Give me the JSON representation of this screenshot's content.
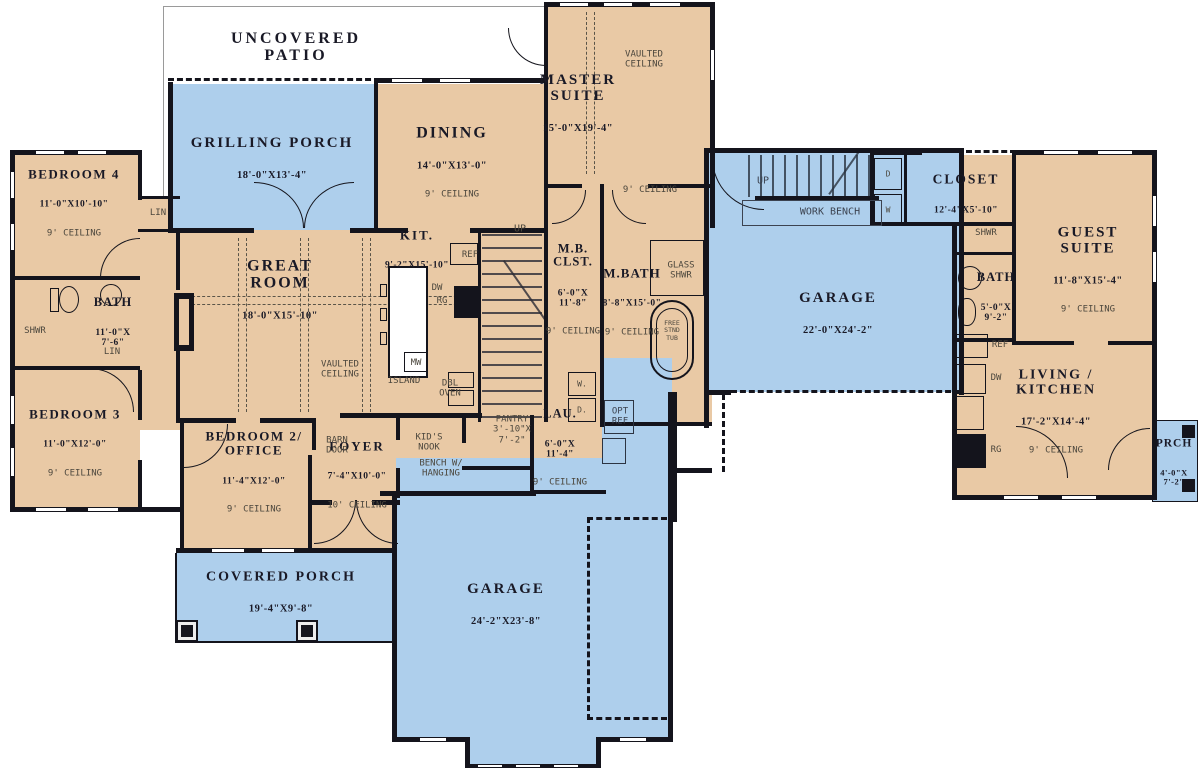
{
  "plan_title": "First floor plan",
  "colors": {
    "room_fill_tan": "#e9c9a5",
    "porch_garage_blue": "#aecfec",
    "wall": "#14141c",
    "room_label": "#191926",
    "annotation": "#4c473d",
    "background": "#ffffff"
  },
  "rooms": {
    "patio": {
      "name": "UNCOVERED\nPATIO"
    },
    "grilling": {
      "name": "GRILLING PORCH",
      "dims": "18'-0\"X13'-4\""
    },
    "dining": {
      "name": "DINING",
      "dims": "14'-0\"X13'-0\"",
      "ceiling": "9' CEILING"
    },
    "master": {
      "name": "MASTER\nSUITE",
      "dims": "15'-0\"X19'-4\""
    },
    "bedroom4": {
      "name": "BEDROOM 4",
      "dims": "11'-0\"X10'-10\"",
      "ceiling": "9' CEILING"
    },
    "great": {
      "name": "GREAT\nROOM",
      "dims": "18'-0\"X15'-10\""
    },
    "kitchen": {
      "name": "KIT.",
      "dims": "9'-2\"X15'-10\""
    },
    "mbclst": {
      "name": "M.B.\nCLST.",
      "dims": "6'-0\"X\n11'-8\"",
      "ceiling": "9' CEILING"
    },
    "mbath": {
      "name": "M.BATH",
      "dims": "8'-8\"X15'-0\"",
      "ceiling": "9' CEILING"
    },
    "garage_r": {
      "name": "GARAGE",
      "dims": "22'-0\"X24'-2\""
    },
    "closet": {
      "name": "CLOSET",
      "dims": "12'-4\"X5'-10\""
    },
    "guest": {
      "name": "GUEST SUITE",
      "dims": "11'-8\"X15'-4\"",
      "ceiling": "9' CEILING"
    },
    "gbath": {
      "name": "BATH",
      "dims": "5'-0\"X\n9'-2\""
    },
    "living": {
      "name": "LIVING /\nKITCHEN",
      "dims": "17'-2\"X14'-4\"",
      "ceiling": "9' CEILING"
    },
    "prch": {
      "name": "PRCH",
      "dims": "4'-0\"X\n7'-2\""
    },
    "bath_l": {
      "name": "BATH",
      "dims": "11'-0\"X\n7'-6\""
    },
    "bedroom3": {
      "name": "BEDROOM 3",
      "dims": "11'-0\"X12'-0\"",
      "ceiling": "9' CEILING"
    },
    "bedroom2": {
      "name": "BEDROOM 2/\nOFFICE",
      "dims": "11'-4\"X12'-0\"",
      "ceiling": "9' CEILING"
    },
    "foyer": {
      "name": "FOYER",
      "dims": "7'-4\"X10'-0\"",
      "ceiling": "10' CEILING"
    },
    "laundry": {
      "name": "LAU.",
      "dims": "6'-0\"X\n11'-4\"",
      "ceiling": "9' CEILING"
    },
    "cporch": {
      "name": "COVERED PORCH",
      "dims": "19'-4\"X9'-8\""
    },
    "garage_b": {
      "name": "GARAGE",
      "dims": "24'-2\"X23'-8\""
    }
  },
  "ann": {
    "vaulted": "VAULTED\nCEILING",
    "ceiling9": "9' CEILING",
    "up": "UP",
    "work_bench": "WORK BENCH",
    "lin": "LIN",
    "shwr": "SHWR",
    "glass_shwr": "GLASS\nSHWR",
    "tub": "FREE\nSTND\nTUB",
    "ref": "REF",
    "opt_ref": "OPT\nREF",
    "rg": "RG",
    "dw": "DW",
    "mw": "MW",
    "island": "ISLAND",
    "dbl_oven": "DBL\nOVEN",
    "pantry": "PANTRY\n3'-10\"X\n7'-2\"",
    "kids_nook": "KID'S\nNOOK",
    "bench": "BENCH W/\nHANGING",
    "barn_door": "BARN\nDOOR",
    "w_dot": "W.",
    "d_dot": "D.",
    "d": "D",
    "w": "W"
  }
}
